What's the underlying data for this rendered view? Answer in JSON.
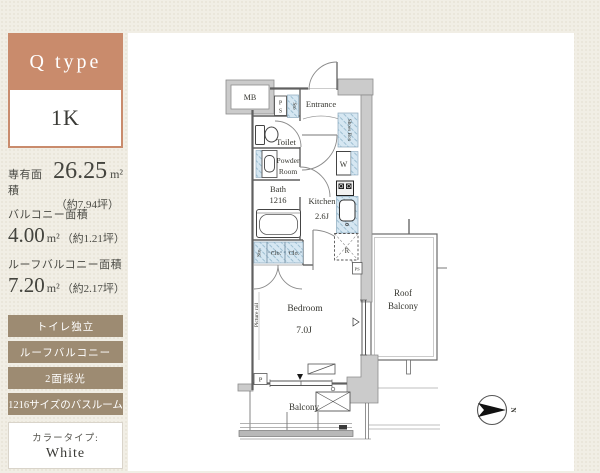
{
  "colors": {
    "accent_salmon": "#c98b6c",
    "tag_brown": "#9d8b72",
    "page_cream": "#f1eee5",
    "plan_blue": "#d6e7f2"
  },
  "sidebar": {
    "type_label": "Q type",
    "layout_label": "1K",
    "area_rows": [
      {
        "label": "専有面積",
        "value": "26.25",
        "unit": "m²",
        "note": "（約7.94坪）"
      },
      {
        "label": "バルコニー面積",
        "value": "4.00",
        "unit": "m²",
        "note": "（約1.21坪）"
      },
      {
        "label": "ルーフバルコニー面積",
        "value": "7.20",
        "unit": "m²",
        "note": "（約2.17坪）"
      }
    ],
    "tags": [
      "トイレ独立",
      "ルーフバルコニー",
      "2面採光",
      "1216サイズのバスルーム"
    ],
    "color_type_label": "カラータイプ:",
    "color_type_value": "White"
  },
  "floorplan": {
    "mb": "MB",
    "ps_top": [
      "P",
      "S"
    ],
    "sto_top": "Sto",
    "entrance": "Entrance",
    "shoes_box": "Shoes Box",
    "toilet": "Toilet",
    "powder_room": [
      "Powder",
      "Room"
    ],
    "bath": [
      "Bath",
      "1216"
    ],
    "washer": "W",
    "kitchen": [
      "Kitchen",
      "2.6J"
    ],
    "fridge": "R",
    "ps_small": "PS",
    "closet_sto": "Sto.",
    "closet_clo1": "Clo.",
    "closet_clo2": "Clo.",
    "picture_rail": "Picture rail",
    "bedroom": [
      "Bedroom",
      "7.0J"
    ],
    "roof_balcony": [
      "Roof",
      "Balcony"
    ],
    "balcony": "Balcony",
    "p_label": "P",
    "compass_n": "N"
  }
}
